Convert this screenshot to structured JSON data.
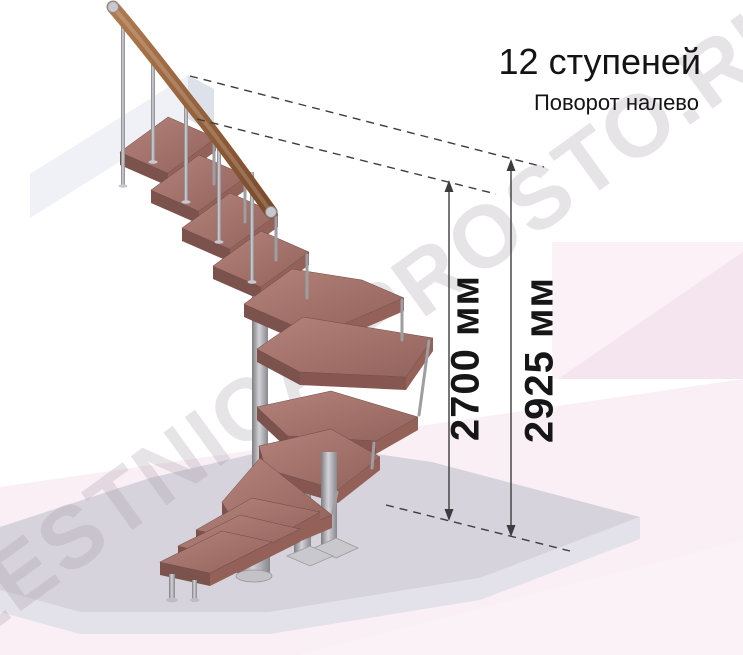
{
  "annotation": {
    "title": "12 ступеней",
    "subtitle": "Поворот налево"
  },
  "dimensions": {
    "stair_height": "2700 мм",
    "total_height": "2925 мм"
  },
  "watermark": {
    "text": "LESTNICA-PROSTO.RU"
  },
  "palette": {
    "wood_step_top": "#a5746d",
    "wood_step_front": "#7c524d",
    "wood_handrail": "#9a6a44",
    "metal": "#b9b9bd",
    "floor_slab": "#d6d3dc",
    "upper_slab": "#eff1f6",
    "background_pink": "#faeff5",
    "dimension_line": "#3d3d3d",
    "text": "#141414"
  }
}
